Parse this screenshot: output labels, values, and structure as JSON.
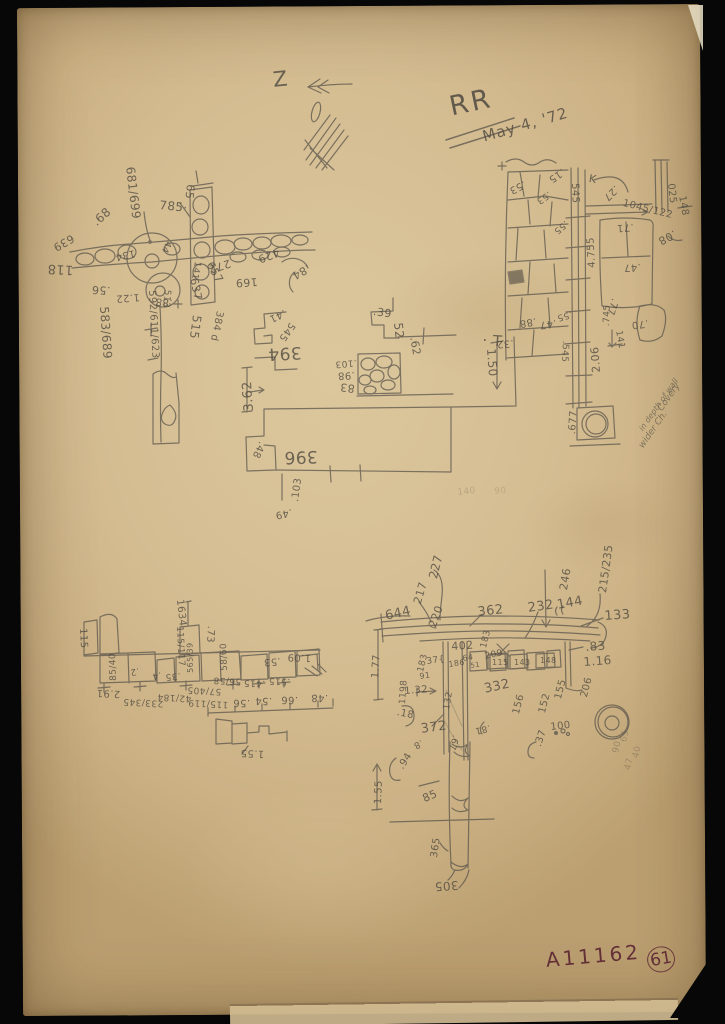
{
  "header": {
    "orientation_mark": "Z",
    "locus": "RR",
    "date": "May 4, '72"
  },
  "footer": {
    "catalog_number": "A11162",
    "page_number": "61"
  },
  "colors": {
    "paper": "#d5bd92",
    "pencil": "#57524a",
    "ink": "#5d2733",
    "background": "#070707"
  },
  "annotations": [
    {
      "t": "681/699",
      "x": 136,
      "y": 166,
      "r": 83,
      "s": 12,
      "g": "A"
    },
    {
      "t": "785·",
      "x": 160,
      "y": 199,
      "r": 6,
      "s": 12,
      "g": "A"
    },
    {
      "t": "65",
      "x": 196,
      "y": 185,
      "r": 96,
      "s": 11,
      "g": "A"
    },
    {
      "t": ".68",
      "x": 90,
      "y": 219,
      "r": -42,
      "s": 12,
      "g": "A"
    },
    {
      "t": "639",
      "x": 76,
      "y": 242,
      "r": 150,
      "s": 11,
      "g": "A"
    },
    {
      "t": "118",
      "x": 73,
      "y": 276,
      "r": 183,
      "s": 13,
      "g": "A"
    },
    {
      "t": ".56",
      "x": 110,
      "y": 296,
      "r": 183,
      "s": 11,
      "g": "A"
    },
    {
      "t": "134",
      "x": 136,
      "y": 257,
      "r": 168,
      "s": 10,
      "g": "A"
    },
    {
      "t": "1.22",
      "x": 140,
      "y": 301,
      "r": 176,
      "s": 10,
      "g": "A"
    },
    {
      "t": "44",
      "x": 172,
      "y": 243,
      "r": 115,
      "s": 9,
      "g": "A"
    },
    {
      "t": "141",
      "x": 201,
      "y": 262,
      "r": 100,
      "s": 9,
      "g": "A"
    },
    {
      "t": "637",
      "x": 199,
      "y": 277,
      "r": 78,
      "s": 11,
      "g": "A"
    },
    {
      "t": "657",
      "x": 214,
      "y": 260,
      "r": 60,
      "s": 11,
      "g": "A"
    },
    {
      "t": "272",
      "x": 232,
      "y": 268,
      "r": 162,
      "s": 11,
      "g": "A"
    },
    {
      "t": "429",
      "x": 281,
      "y": 257,
      "r": 160,
      "s": 11,
      "g": "A"
    },
    {
      "t": "169",
      "x": 258,
      "y": 287,
      "r": 176,
      "s": 11,
      "g": "A"
    },
    {
      "t": ".84",
      "x": 312,
      "y": 272,
      "r": 150,
      "s": 11,
      "g": "A"
    },
    {
      "t": "583/689",
      "x": 110,
      "y": 306,
      "r": 86,
      "s": 12,
      "g": "A"
    },
    {
      "t": "592/611/623",
      "x": 156,
      "y": 290,
      "r": 87,
      "s": 10,
      "g": "A"
    },
    {
      "t": "513",
      "x": 171,
      "y": 290,
      "r": 95,
      "s": 9,
      "g": "A"
    },
    {
      "t": "515",
      "x": 203,
      "y": 316,
      "r": 98,
      "s": 12,
      "g": "A"
    },
    {
      "t": "384 d",
      "x": 224,
      "y": 312,
      "r": 102,
      "s": 10,
      "g": "A"
    },
    {
      "t": ".88",
      "x": 172,
      "y": 307,
      "r": 186,
      "s": 10,
      "g": "A"
    },
    {
      "t": "394",
      "x": 302,
      "y": 360,
      "r": 177,
      "s": 17,
      "g": "B"
    },
    {
      "t": ".41",
      "x": 287,
      "y": 316,
      "r": 155,
      "s": 10,
      "g": "B"
    },
    {
      "t": "545",
      "x": 296,
      "y": 326,
      "r": 125,
      "s": 10,
      "g": "B"
    },
    {
      "t": "3.62",
      "x": 243,
      "y": 412,
      "r": -94,
      "s": 13,
      "g": "B"
    },
    {
      "t": ".39",
      "x": 374,
      "y": 306,
      "r": 8,
      "s": 11,
      "g": "C"
    },
    {
      "t": "52",
      "x": 404,
      "y": 322,
      "r": 84,
      "s": 12,
      "g": "C"
    },
    {
      "t": ".62",
      "x": 419,
      "y": 336,
      "r": 80,
      "s": 11,
      "g": "C"
    },
    {
      "t": ".103",
      "x": 357,
      "y": 366,
      "r": 175,
      "s": 9,
      "g": "C"
    },
    {
      "t": ".98",
      "x": 355,
      "y": 379,
      "r": 177,
      "s": 10,
      "g": "C"
    },
    {
      "t": "83",
      "x": 354,
      "y": 394,
      "r": 187,
      "s": 11,
      "g": "C"
    },
    {
      "t": "· T",
      "x": 483,
      "y": 333,
      "r": 4,
      "s": 15,
      "g": "C"
    },
    {
      "t": "1.50",
      "x": 497,
      "y": 348,
      "r": 86,
      "s": 12,
      "g": "C"
    },
    {
      "t": "396",
      "x": 318,
      "y": 464,
      "r": 178,
      "s": 17,
      "g": "D"
    },
    {
      "t": ".48",
      "x": 266,
      "y": 444,
      "r": 115,
      "s": 10,
      "g": "D"
    },
    {
      "t": ".103",
      "x": 291,
      "y": 501,
      "r": -82,
      "s": 10,
      "g": "D"
    },
    {
      "t": ".49",
      "x": 293,
      "y": 516,
      "r": 168,
      "s": 10,
      "g": "D"
    },
    {
      "t": "K",
      "x": 590,
      "y": 173,
      "r": 10,
      "s": 11,
      "g": "E"
    },
    {
      "t": "545",
      "x": 579,
      "y": 183,
      "r": 88,
      "s": 10,
      "g": "E"
    },
    {
      "t": ".15",
      "x": 566,
      "y": 174,
      "r": 145,
      "s": 10,
      "g": "E"
    },
    {
      "t": ".53",
      "x": 527,
      "y": 187,
      "r": 152,
      "s": 10,
      "g": "E"
    },
    {
      "t": ".53",
      "x": 552,
      "y": 196,
      "r": 145,
      "s": 9,
      "g": "E"
    },
    {
      "t": ".55",
      "x": 569,
      "y": 225,
      "r": 140,
      "s": 9,
      "g": "E"
    },
    {
      "t": ".27",
      "x": 620,
      "y": 190,
      "r": 135,
      "s": 10,
      "g": "E"
    },
    {
      "t": "1045/122",
      "x": 624,
      "y": 199,
      "r": 14,
      "s": 10,
      "g": "E"
    },
    {
      "t": "025",
      "x": 675,
      "y": 183,
      "r": 84,
      "s": 10,
      "g": "E"
    },
    {
      "t": "148",
      "x": 686,
      "y": 195,
      "r": 80,
      "s": 10,
      "g": "E"
    },
    {
      "t": ".08",
      "x": 678,
      "y": 238,
      "r": 152,
      "s": 11,
      "g": "E"
    },
    {
      "t": ".71",
      "x": 634,
      "y": 231,
      "r": 176,
      "s": 10,
      "g": "E"
    },
    {
      "t": ".47",
      "x": 641,
      "y": 271,
      "r": 177,
      "s": 10,
      "g": "E"
    },
    {
      "t": "4.755",
      "x": 588,
      "y": 268,
      "r": -93,
      "s": 10,
      "g": "E"
    },
    {
      "t": ".88",
      "x": 537,
      "y": 325,
      "r": 170,
      "s": 10,
      "g": "E"
    },
    {
      "t": ".47",
      "x": 557,
      "y": 327,
      "r": 172,
      "s": 10,
      "g": "E"
    },
    {
      "t": ".55",
      "x": 573,
      "y": 317,
      "r": 163,
      "s": 9,
      "g": "E"
    },
    {
      "t": ".32",
      "x": 514,
      "y": 347,
      "r": 175,
      "s": 10,
      "g": "E"
    },
    {
      "t": ".545",
      "x": 569,
      "y": 341,
      "r": 93,
      "s": 9,
      "g": "E"
    },
    {
      "t": "2.06",
      "x": 591,
      "y": 373,
      "r": -94,
      "s": 11,
      "g": "E"
    },
    {
      "t": ".745",
      "x": 603,
      "y": 326,
      "r": -88,
      "s": 9,
      "g": "E"
    },
    {
      "t": ".77",
      "x": 619,
      "y": 300,
      "r": 108,
      "s": 10,
      "g": "E"
    },
    {
      "t": ".70",
      "x": 649,
      "y": 327,
      "r": 172,
      "s": 10,
      "g": "E"
    },
    {
      "t": "141",
      "x": 622,
      "y": 330,
      "r": 80,
      "s": 9,
      "g": "E"
    },
    {
      "t": ".677",
      "x": 568,
      "y": 434,
      "r": -86,
      "s": 10,
      "g": "E"
    },
    {
      "t": "Covery",
      "x": 657,
      "y": 408,
      "r": -55,
      "s": 9,
      "i": 1,
      "n": "field-note-line",
      "g": "E"
    },
    {
      "t": "in depth of wall",
      "x": 638,
      "y": 428,
      "r": -55,
      "s": 8,
      "i": 1,
      "n": "field-note-line",
      "g": "E"
    },
    {
      "t": "wider Ch.",
      "x": 638,
      "y": 445,
      "r": -55,
      "s": 9,
      "i": 1,
      "n": "field-note-line",
      "g": "E"
    },
    {
      "t": "115",
      "x": 87,
      "y": 628,
      "r": 87,
      "s": 10,
      "g": "F"
    },
    {
      "t": "1634",
      "x": 184,
      "y": 599,
      "r": 84,
      "s": 10,
      "g": "F"
    },
    {
      "t": "115/117",
      "x": 183,
      "y": 626,
      "r": 87,
      "s": 9,
      "g": "F"
    },
    {
      "t": ".73",
      "x": 215,
      "y": 626,
      "r": 93,
      "s": 10,
      "g": "F"
    },
    {
      "t": "85/40",
      "x": 110,
      "y": 681,
      "r": -92,
      "s": 9,
      "g": "F"
    },
    {
      "t": ".2",
      "x": 140,
      "y": 674,
      "r": 168,
      "s": 9,
      "g": "F"
    },
    {
      "t": ".4",
      "x": 162,
      "y": 678,
      "r": 168,
      "s": 9,
      "g": "F"
    },
    {
      "t": ".35",
      "x": 181,
      "y": 679,
      "r": 174,
      "s": 9,
      "g": "F"
    },
    {
      "t": "565/39",
      "x": 187,
      "y": 673,
      "r": -91,
      "s": 8,
      "g": "F"
    },
    {
      "t": "58/60",
      "x": 221,
      "y": 671,
      "r": -92,
      "s": 9,
      "g": "F"
    },
    {
      "t": ".53",
      "x": 281,
      "y": 665,
      "r": 175,
      "s": 10,
      "g": "F"
    },
    {
      "t": "1.09",
      "x": 311,
      "y": 662,
      "r": 182,
      "s": 10,
      "g": "F"
    },
    {
      "t": ".515",
      "x": 290,
      "y": 685,
      "r": 182,
      "s": 9,
      "g": "F"
    },
    {
      "t": ".415",
      "x": 265,
      "y": 687,
      "r": 182,
      "s": 9,
      "g": "F"
    },
    {
      "t": "56/58",
      "x": 241,
      "y": 685,
      "r": 183,
      "s": 9,
      "g": "F"
    },
    {
      "t": "2.91",
      "x": 120,
      "y": 698,
      "r": 183,
      "s": 10,
      "g": "F"
    },
    {
      "t": "233/345",
      "x": 163,
      "y": 707,
      "r": 183,
      "s": 9,
      "g": "F"
    },
    {
      "t": "42/184",
      "x": 191,
      "y": 702,
      "r": 183,
      "s": 9,
      "g": "F"
    },
    {
      "t": "115/119",
      "x": 228,
      "y": 708,
      "r": 183,
      "s": 9,
      "g": "F"
    },
    {
      "t": "57/405",
      "x": 221,
      "y": 695,
      "r": 183,
      "s": 9,
      "g": "F"
    },
    {
      "t": ".56",
      "x": 250,
      "y": 707,
      "r": 181,
      "s": 10,
      "g": "F"
    },
    {
      "t": ".54",
      "x": 272,
      "y": 705,
      "r": 181,
      "s": 10,
      "g": "F"
    },
    {
      "t": ".66",
      "x": 298,
      "y": 704,
      "r": 181,
      "s": 10,
      "g": "F"
    },
    {
      "t": ".48",
      "x": 328,
      "y": 702,
      "r": 181,
      "s": 10,
      "g": "F"
    },
    {
      "t": "1.55",
      "x": 264,
      "y": 758,
      "r": 183,
      "s": 10,
      "g": "F"
    },
    {
      "t": "227",
      "x": 427,
      "y": 577,
      "r": -76,
      "s": 12,
      "g": "G"
    },
    {
      "t": "217",
      "x": 412,
      "y": 602,
      "r": -74,
      "s": 11,
      "g": "G"
    },
    {
      "t": "220",
      "x": 427,
      "y": 625,
      "r": -70,
      "s": 11,
      "g": "G"
    },
    {
      "t": "644",
      "x": 384,
      "y": 610,
      "r": -12,
      "s": 13,
      "g": "G"
    },
    {
      "t": "362",
      "x": 477,
      "y": 606,
      "r": -6,
      "s": 13,
      "g": "G"
    },
    {
      "t": "232",
      "x": 527,
      "y": 602,
      "r": -8,
      "s": 13,
      "g": "G"
    },
    {
      "t": "144",
      "x": 556,
      "y": 599,
      "r": -10,
      "s": 13,
      "g": "G"
    },
    {
      "t": "246",
      "x": 558,
      "y": 589,
      "r": -80,
      "s": 11,
      "g": "G"
    },
    {
      "t": "215/235",
      "x": 597,
      "y": 592,
      "r": -82,
      "s": 11,
      "g": "G"
    },
    {
      "t": "133",
      "x": 604,
      "y": 610,
      "r": -4,
      "s": 13,
      "g": "G"
    },
    {
      "t": ".83",
      "x": 585,
      "y": 641,
      "r": -4,
      "s": 12,
      "g": "G"
    },
    {
      "t": "1.16",
      "x": 583,
      "y": 656,
      "r": -4,
      "s": 12,
      "g": "G"
    },
    {
      "t": "402",
      "x": 451,
      "y": 641,
      "r": -4,
      "s": 11,
      "g": "G"
    },
    {
      "t": "183",
      "x": 480,
      "y": 647,
      "r": -76,
      "s": 9,
      "g": "G"
    },
    {
      "t": "183",
      "x": 417,
      "y": 671,
      "r": -76,
      "s": 9,
      "g": "G"
    },
    {
      "t": "37{",
      "x": 426,
      "y": 658,
      "r": -8,
      "s": 9,
      "g": "G"
    },
    {
      "t": "186",
      "x": 448,
      "y": 661,
      "r": -8,
      "s": 8,
      "g": "G"
    },
    {
      "t": "64",
      "x": 462,
      "y": 655,
      "r": -8,
      "s": 8,
      "g": "G"
    },
    {
      "t": "51",
      "x": 470,
      "y": 663,
      "r": -8,
      "s": 7,
      "g": "G"
    },
    {
      "t": "209",
      "x": 484,
      "y": 653,
      "r": -12,
      "s": 9,
      "g": "G"
    },
    {
      "t": "115",
      "x": 492,
      "y": 659,
      "r": 0,
      "s": 8,
      "g": "G"
    },
    {
      "t": "143",
      "x": 514,
      "y": 659,
      "r": 0,
      "s": 8,
      "g": "G"
    },
    {
      "t": "148",
      "x": 540,
      "y": 657,
      "r": 0,
      "s": 8,
      "g": "G"
    },
    {
      "t": "91",
      "x": 419,
      "y": 673,
      "r": -8,
      "s": 8,
      "g": "G"
    },
    {
      "t": "1.32",
      "x": 404,
      "y": 687,
      "r": -4,
      "s": 10,
      "g": "G"
    },
    {
      "t": "1198",
      "x": 399,
      "y": 704,
      "r": -86,
      "s": 9,
      "g": "G"
    },
    {
      "t": "1.77",
      "x": 371,
      "y": 678,
      "r": -86,
      "s": 10,
      "g": "G"
    },
    {
      "t": ".18",
      "x": 398,
      "y": 708,
      "r": 12,
      "s": 10,
      "g": "G"
    },
    {
      "t": "372",
      "x": 420,
      "y": 723,
      "r": -8,
      "s": 13,
      "g": "G"
    },
    {
      "t": "132",
      "x": 443,
      "y": 709,
      "r": -80,
      "s": 9,
      "g": "G"
    },
    {
      "t": "332",
      "x": 483,
      "y": 683,
      "r": -12,
      "s": 13,
      "g": "G"
    },
    {
      "t": "156",
      "x": 512,
      "y": 713,
      "r": -76,
      "s": 10,
      "g": "G"
    },
    {
      "t": "152",
      "x": 538,
      "y": 712,
      "r": -76,
      "s": 10,
      "g": "G"
    },
    {
      "t": "155",
      "x": 554,
      "y": 698,
      "r": -76,
      "s": 10,
      "g": "G"
    },
    {
      "t": "206",
      "x": 580,
      "y": 696,
      "r": -76,
      "s": 10,
      "g": "G"
    },
    {
      "t": "100",
      "x": 550,
      "y": 723,
      "r": -6,
      "s": 10,
      "g": "G"
    },
    {
      "t": ".37",
      "x": 534,
      "y": 745,
      "r": -72,
      "s": 10,
      "g": "G"
    },
    {
      "t": ".81",
      "x": 491,
      "y": 731,
      "r": 167,
      "s": 9,
      "g": "G"
    },
    {
      "t": ".67",
      "x": 459,
      "y": 736,
      "r": 105,
      "s": 9,
      "g": "G"
    },
    {
      "t": ".8",
      "x": 424,
      "y": 745,
      "r": 152,
      "s": 9,
      "g": "G"
    },
    {
      "t": ".94",
      "x": 397,
      "y": 766,
      "r": -58,
      "s": 10,
      "g": "G"
    },
    {
      "t": "1.55",
      "x": 374,
      "y": 804,
      "r": -88,
      "s": 10,
      "g": "G"
    },
    {
      "t": "85",
      "x": 421,
      "y": 794,
      "r": -24,
      "s": 11,
      "g": "G"
    },
    {
      "t": "365",
      "x": 430,
      "y": 857,
      "r": -82,
      "s": 10,
      "g": "G"
    },
    {
      "t": "305",
      "x": 459,
      "y": 891,
      "r": 176,
      "s": 12,
      "g": "G"
    },
    {
      "t": "90",
      "x": 612,
      "y": 752,
      "r": -76,
      "s": 9,
      "o": 0.35,
      "g": "G"
    },
    {
      "t": "65",
      "x": 620,
      "y": 741,
      "r": -76,
      "s": 9,
      "o": 0.32,
      "g": "G"
    },
    {
      "t": "47",
      "x": 624,
      "y": 769,
      "r": -76,
      "s": 9,
      "o": 0.3,
      "g": "G"
    },
    {
      "t": "40",
      "x": 632,
      "y": 757,
      "r": -76,
      "s": 9,
      "o": 0.3,
      "g": "G"
    },
    {
      "t": "140",
      "x": 457,
      "y": 489,
      "r": -6,
      "s": 9,
      "o": 0.22,
      "g": "center"
    },
    {
      "t": "90",
      "x": 494,
      "y": 488,
      "r": -4,
      "s": 9,
      "o": 0.18,
      "g": "center"
    }
  ]
}
